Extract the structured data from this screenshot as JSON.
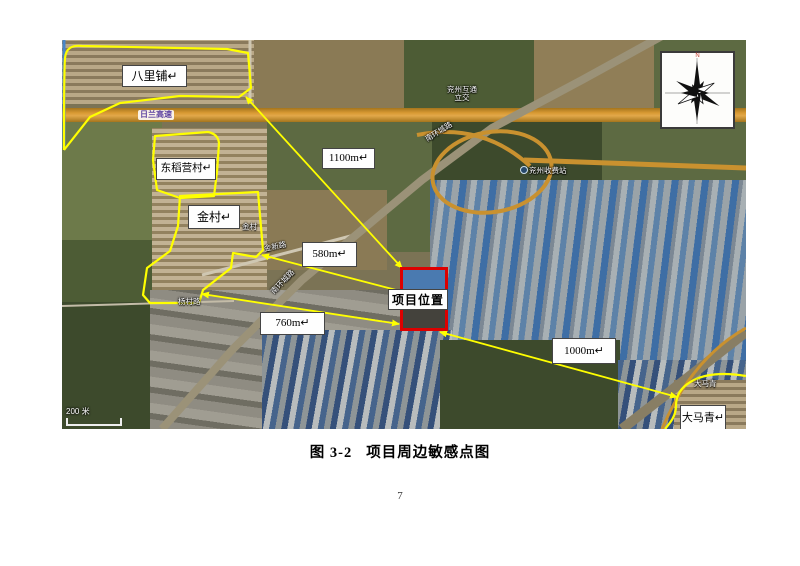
{
  "figure": {
    "caption_prefix": "图 3-2",
    "caption_title": "项目周边敏感点图",
    "page_number": "7"
  },
  "map": {
    "scale_label": "200 米",
    "compass_north": "N",
    "labels": {
      "balipu": "八里铺↵",
      "dongdaoyingcun": "东稻营村↵",
      "jincun": "金村↵",
      "damaqing": "大马青↵",
      "project_location": "项目位置"
    },
    "distances": {
      "balipu": "1100m↵",
      "jincun_east": "580m↵",
      "jincun_south": "760m↵",
      "damaqing": "1000m↵"
    },
    "map_text": {
      "highway": "日兰高速",
      "ring_road_northeast": "南环城路",
      "ring_road_southwest": "南环城路",
      "interchange_line1": "兖州互通",
      "interchange_line2": "立交",
      "toll_station": "兖州收费站",
      "jincun_small": "金村",
      "damaqing_small": "大马青",
      "road_jinxin": "金新路",
      "road_yangcun": "杨村路"
    },
    "colors": {
      "annotation_yellow": "#ffff00",
      "project_red": "#dd0000",
      "highway_orange": "#c9912f"
    }
  }
}
